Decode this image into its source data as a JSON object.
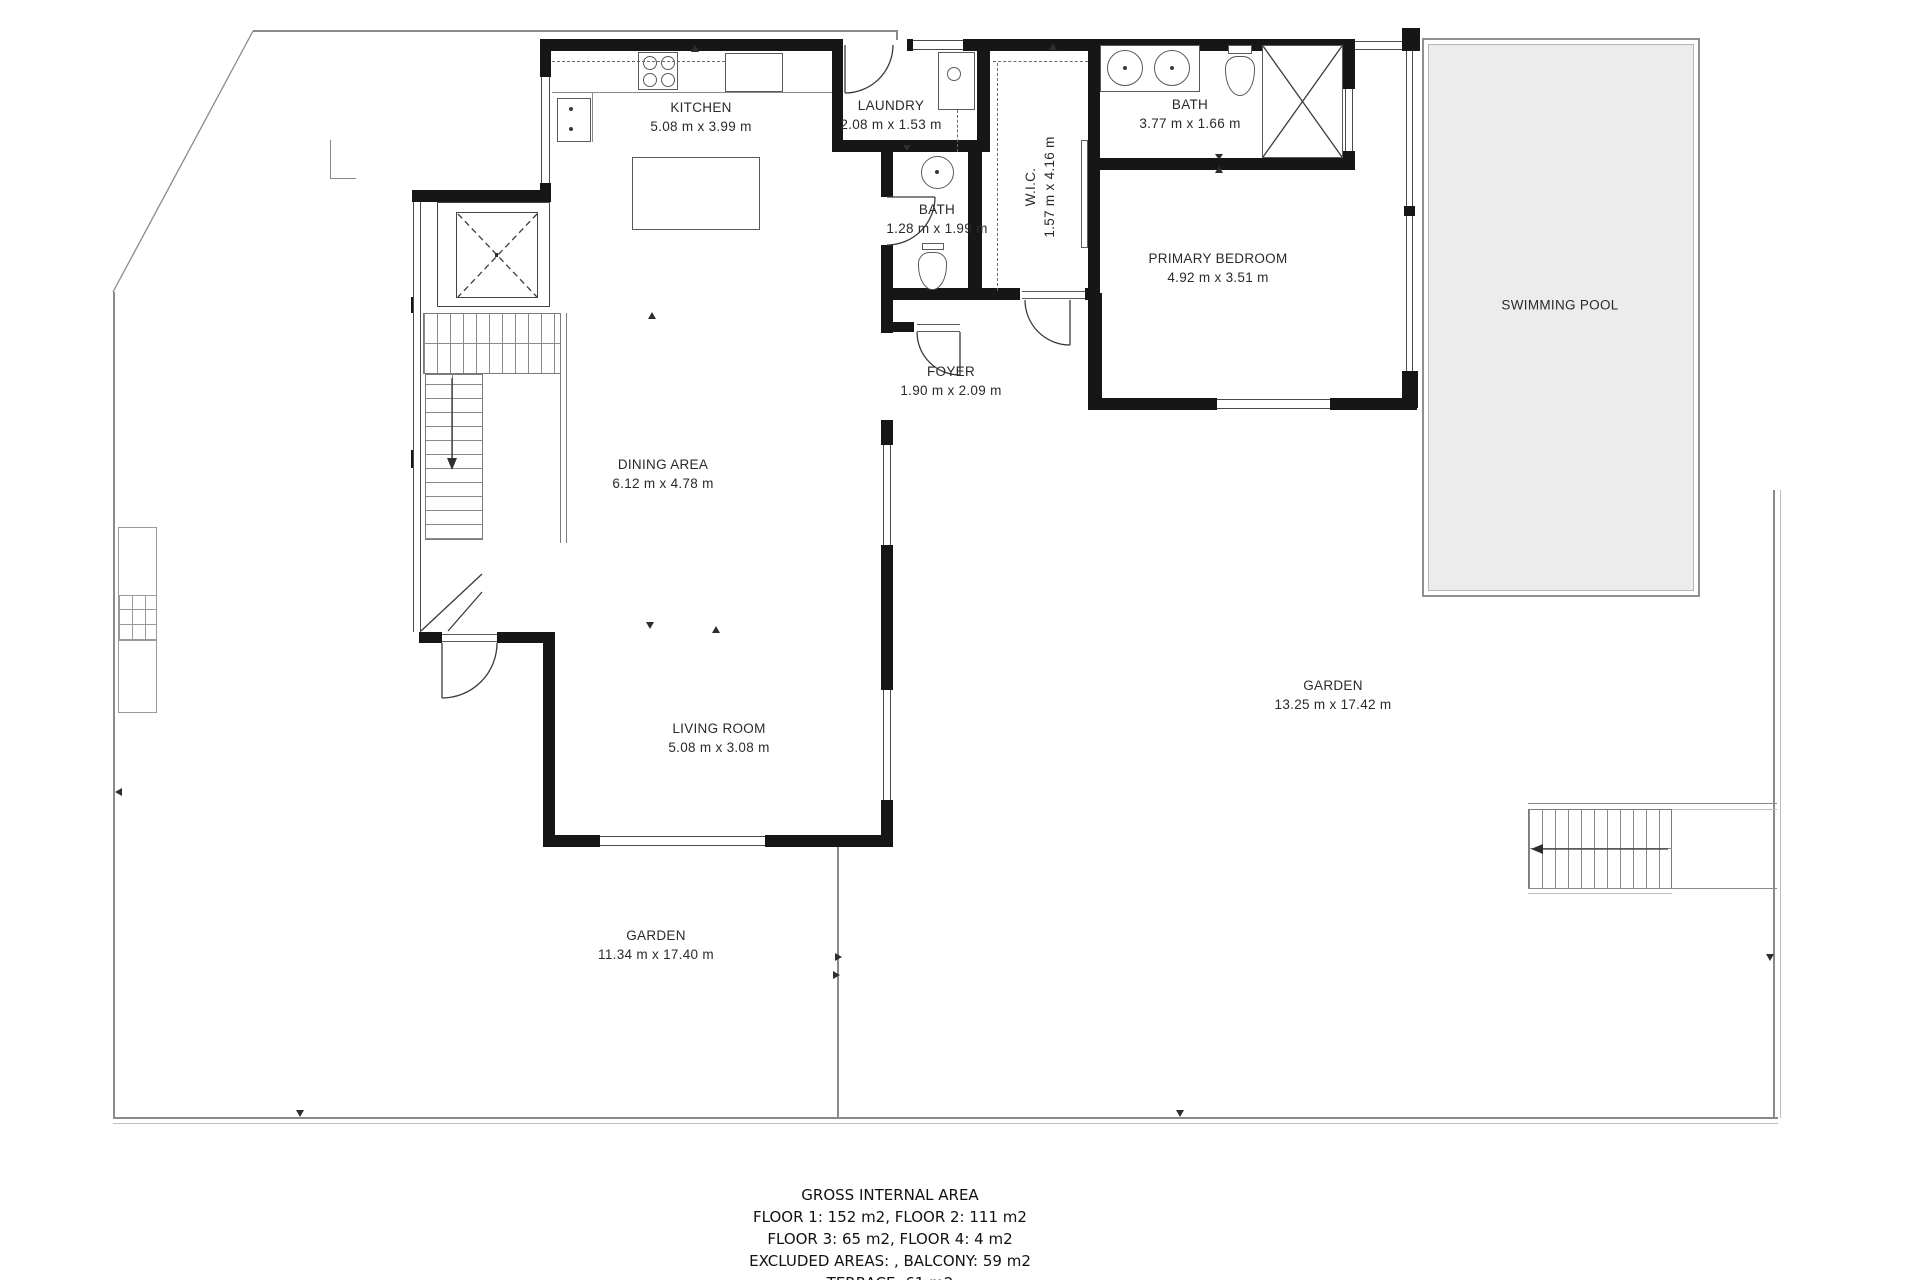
{
  "rooms": {
    "kitchen": {
      "name": "KITCHEN",
      "dims": "5.08 m x 3.99 m"
    },
    "laundry": {
      "name": "LAUNDRY",
      "dims": "2.08 m x 1.53 m"
    },
    "bath_main": {
      "name": "BATH",
      "dims": "3.77 m x 1.66 m"
    },
    "wic": {
      "name": "W.I.C.",
      "dims": "1.57 m x 4.16 m"
    },
    "bath_small": {
      "name": "BATH",
      "dims": "1.28 m x 1.99 m"
    },
    "primary_bedroom": {
      "name": "PRIMARY BEDROOM",
      "dims": "4.92 m x 3.51 m"
    },
    "foyer": {
      "name": "FOYER",
      "dims": "1.90 m x 2.09 m"
    },
    "dining": {
      "name": "DINING AREA",
      "dims": "6.12 m x 4.78 m"
    },
    "living": {
      "name": "LIVING ROOM",
      "dims": "5.08 m x 3.08 m"
    }
  },
  "outdoor": {
    "pool": {
      "name": "SWIMMING POOL"
    },
    "garden_east": {
      "name": "GARDEN",
      "dims": "13.25 m x 17.42 m"
    },
    "garden_south": {
      "name": "GARDEN",
      "dims": "11.34 m x 17.40 m"
    }
  },
  "footer": {
    "title": "GROSS INTERNAL AREA",
    "lines": [
      "FLOOR 1: 152 m2, FLOOR 2: 111 m2",
      "FLOOR 3: 65 m2, FLOOR 4: 4 m2",
      "EXCLUDED AREAS: , BALCONY: 59 m2",
      "TERRACE: 61 m2"
    ]
  },
  "colors": {
    "wall": "#161616",
    "thin_line": "#8a8a8a",
    "pool_fill": "#ececec",
    "text": "#2a2a2a"
  }
}
